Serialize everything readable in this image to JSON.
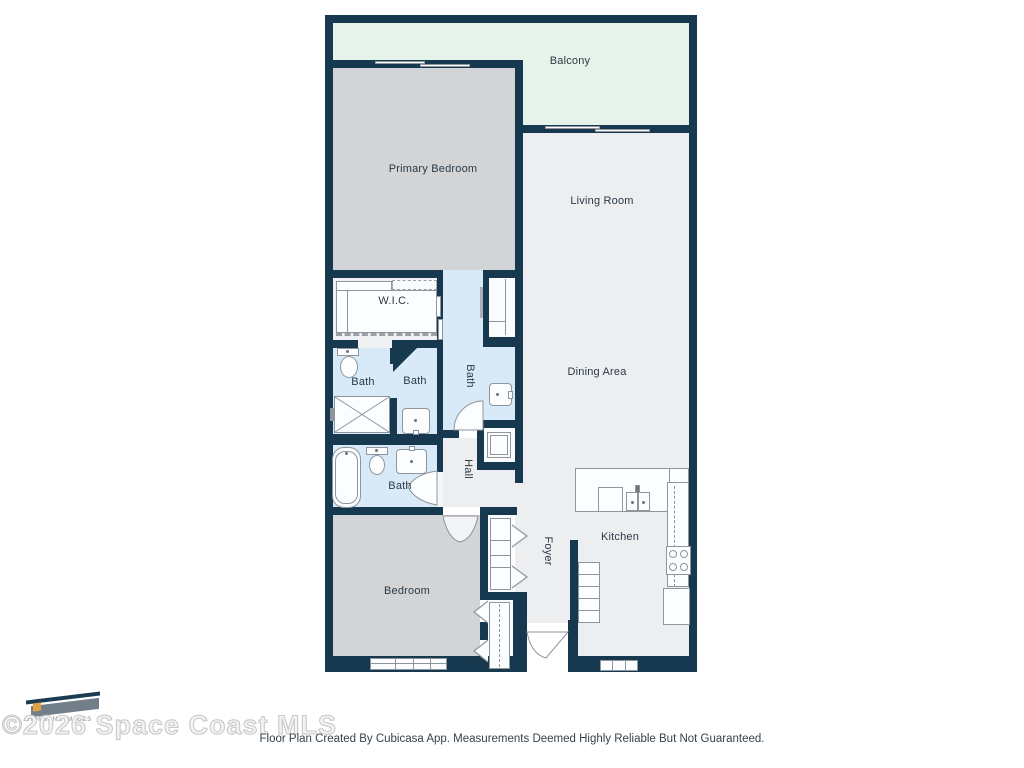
{
  "floor_plan": {
    "rooms": {
      "balcony": "Balcony",
      "primary_bedroom": "Primary Bedroom",
      "living_room": "Living Room",
      "dining_area": "Dining Area",
      "wic": "W.I.C.",
      "bath_left": "Bath",
      "bath_middle": "Bath",
      "bath_primary": "Bath",
      "bath_lower": "Bath",
      "hall": "Hall",
      "foyer": "Foyer",
      "kitchen": "Kitchen",
      "bedroom": "Bedroom"
    },
    "colors": {
      "wall": "#17394F",
      "balcony_floor": "#E6F3EA",
      "bedroom_floor": "#D2D4D6",
      "living_floor": "#EDEEF0",
      "bath_floor": "#D8EAF7",
      "fixture_outline": "#8F959C",
      "label_text": "#2B3A46"
    }
  },
  "watermark": {
    "logo_text": "HOFMANN IMAGES",
    "copyright": "©2026 Space Coast MLS"
  },
  "footer": {
    "disclaimer": "Floor Plan Created By Cubicasa App. Measurements Deemed Highly Reliable But Not Guaranteed."
  }
}
